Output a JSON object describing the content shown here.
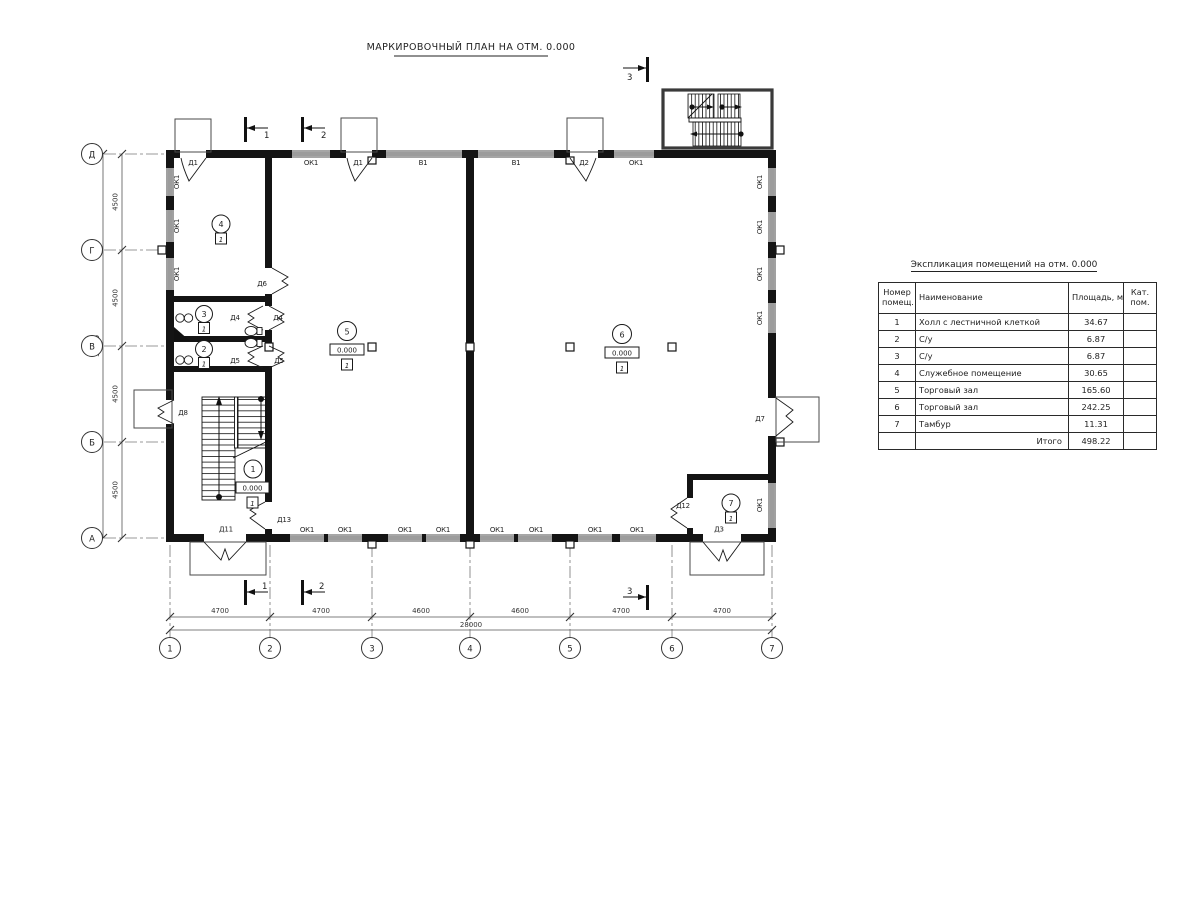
{
  "drawing": {
    "title": "МАРКИРОВОЧНЫЙ ПЛАН НА ОТМ. 0.000"
  },
  "axes": {
    "rows": [
      "Д",
      "Г",
      "В",
      "Б",
      "А"
    ],
    "cols": [
      "1",
      "2",
      "3",
      "4",
      "5",
      "6",
      "7"
    ]
  },
  "dims": {
    "left_segments": [
      "4500",
      "4500",
      "4500",
      "4500"
    ],
    "left_total": "18000",
    "bottom_segments": [
      "4700",
      "4700",
      "4600",
      "4600",
      "4700",
      "4700"
    ],
    "bottom_total": "28000"
  },
  "labels": {
    "ok1": "ОК1",
    "v1": "В1",
    "d1": "Д1",
    "d2": "Д2",
    "d3": "Д3",
    "d4": "Д4",
    "d5": "Д5",
    "d6": "Д6",
    "d7": "Д7",
    "d8": "Д8",
    "d11": "Д11",
    "d12": "Д12",
    "d13": "Д13"
  },
  "rooms": {
    "marks": [
      "1",
      "2",
      "3",
      "4",
      "5",
      "6",
      "7"
    ],
    "elevation": "0.000",
    "floor_type": "1"
  },
  "sections": {
    "s1": "1",
    "s2": "2",
    "s3": "3"
  },
  "schedule": {
    "title": "Экспликация помещений на отм. 0.000",
    "headers": {
      "num_l1": "Номер",
      "num_l2": "помещ.",
      "name": "Наименование",
      "area": "Площадь,  м2",
      "cat_l1": "Кат.",
      "cat_l2": "пом."
    },
    "rows": [
      {
        "num": "1",
        "name": "Холл с лестничной клеткой",
        "area": "34.67"
      },
      {
        "num": "2",
        "name": "С/у",
        "area": "6.87"
      },
      {
        "num": "3",
        "name": "С/у",
        "area": "6.87"
      },
      {
        "num": "4",
        "name": "Служебное помещение",
        "area": "30.65"
      },
      {
        "num": "5",
        "name": "Торговый зал",
        "area": "165.60"
      },
      {
        "num": "6",
        "name": "Торговый зал",
        "area": "242.25"
      },
      {
        "num": "7",
        "name": "Тамбур",
        "area": "11.31"
      }
    ],
    "total_label": "Итого",
    "total_value": "498.22"
  }
}
